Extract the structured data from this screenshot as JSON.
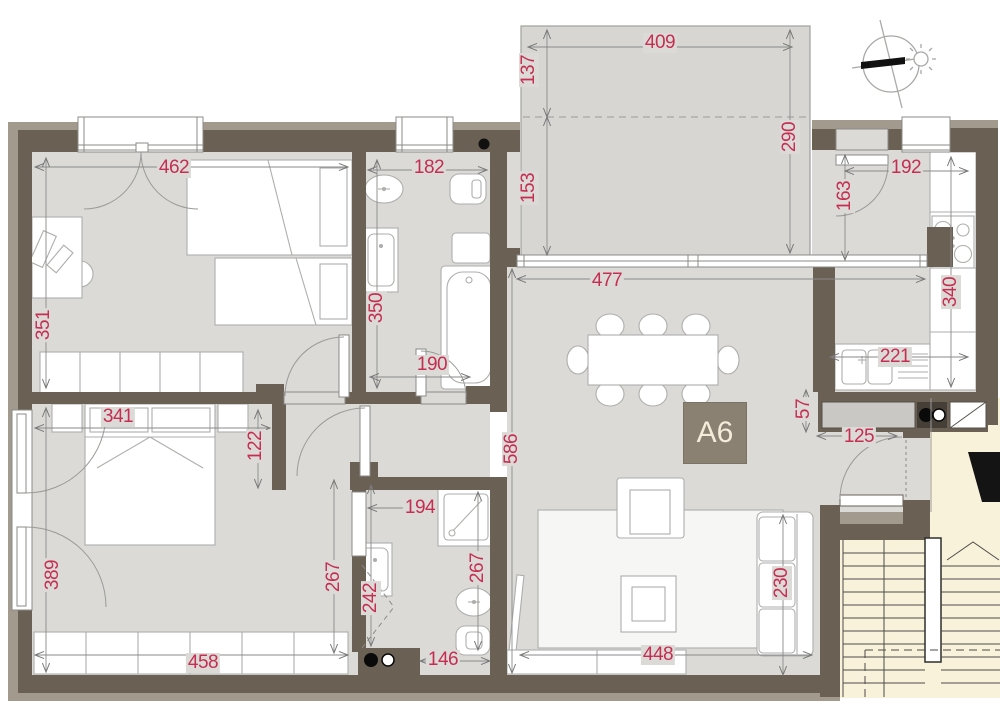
{
  "unit_label": {
    "text": "A6"
  },
  "colors": {
    "dimension_text": "#c62e51",
    "wall": "#6a6054",
    "wall_outer": "#a29a8d",
    "floor": "#dbdad7",
    "terrace": "#d7d6d3",
    "stairwell": "#f9f2da",
    "unit_box": "#8a8173",
    "unit_box_text": "#f4ecd9"
  },
  "compass": {
    "icon": "north-needle-and-sun-compass"
  },
  "dimensions": [
    {
      "text": "462",
      "x": 174,
      "y": 168,
      "vertical": false
    },
    {
      "text": "182",
      "x": 429,
      "y": 168,
      "vertical": false
    },
    {
      "text": "409",
      "x": 660,
      "y": 43,
      "vertical": false
    },
    {
      "text": "137",
      "x": 529,
      "y": 70,
      "vertical": true
    },
    {
      "text": "153",
      "x": 529,
      "y": 188,
      "vertical": true
    },
    {
      "text": "290",
      "x": 790,
      "y": 137,
      "vertical": true
    },
    {
      "text": "192",
      "x": 906,
      "y": 168,
      "vertical": false
    },
    {
      "text": "163",
      "x": 845,
      "y": 196,
      "vertical": true
    },
    {
      "text": "351",
      "x": 44,
      "y": 325,
      "vertical": true
    },
    {
      "text": "350",
      "x": 377,
      "y": 308,
      "vertical": true
    },
    {
      "text": "190",
      "x": 432,
      "y": 365,
      "vertical": false
    },
    {
      "text": "477",
      "x": 607,
      "y": 281,
      "vertical": false
    },
    {
      "text": "340",
      "x": 951,
      "y": 292,
      "vertical": true
    },
    {
      "text": "341",
      "x": 118,
      "y": 417,
      "vertical": false
    },
    {
      "text": "122",
      "x": 256,
      "y": 446,
      "vertical": true
    },
    {
      "text": "586",
      "x": 512,
      "y": 449,
      "vertical": true
    },
    {
      "text": "221",
      "x": 895,
      "y": 357,
      "vertical": false
    },
    {
      "text": "57",
      "x": 804,
      "y": 409,
      "vertical": true
    },
    {
      "text": "125",
      "x": 859,
      "y": 437,
      "vertical": false
    },
    {
      "text": "389",
      "x": 53,
      "y": 575,
      "vertical": true
    },
    {
      "text": "267",
      "x": 334,
      "y": 577,
      "vertical": true
    },
    {
      "text": "194",
      "x": 420,
      "y": 508,
      "vertical": false
    },
    {
      "text": "242",
      "x": 371,
      "y": 598,
      "vertical": true
    },
    {
      "text": "267",
      "x": 478,
      "y": 568,
      "vertical": true
    },
    {
      "text": "230",
      "x": 782,
      "y": 583,
      "vertical": true
    },
    {
      "text": "458",
      "x": 203,
      "y": 663,
      "vertical": false
    },
    {
      "text": "146",
      "x": 443,
      "y": 660,
      "vertical": false
    },
    {
      "text": "448",
      "x": 658,
      "y": 655,
      "vertical": false
    }
  ]
}
